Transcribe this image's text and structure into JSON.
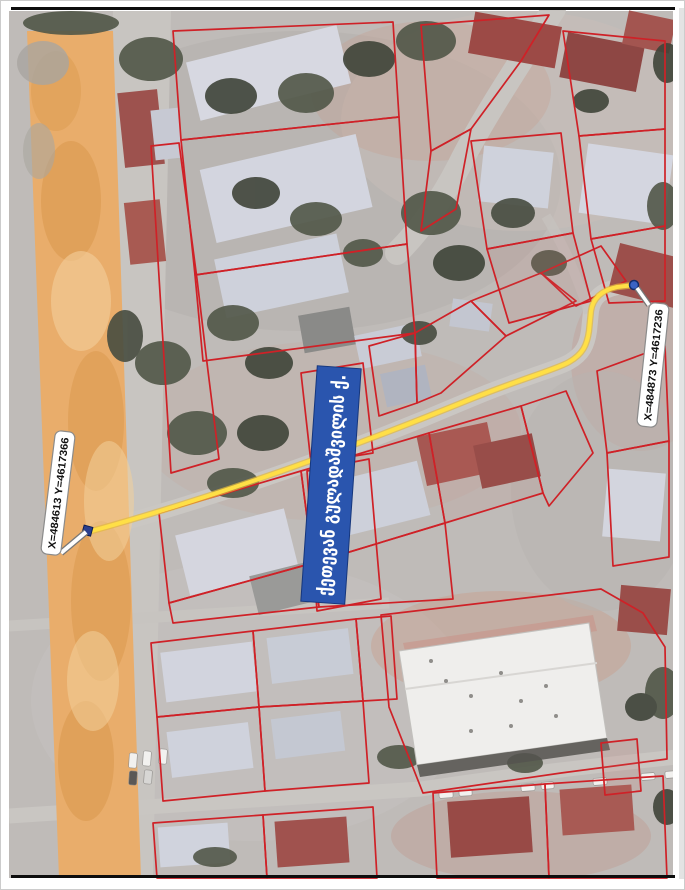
{
  "map": {
    "street_banner": {
      "label": "ქეთევან გულადაშვილის ქ."
    },
    "callout_start": {
      "label": "X=484613 Y=4617366"
    },
    "callout_end": {
      "label": "X=484873 Y=4617236"
    },
    "colors": {
      "parcel": "#cf2127",
      "route": "#ffdf46",
      "route_casing": "#e3b93f",
      "banner": "#2a55ae",
      "highlight_road": "#e9ad6b",
      "marker": "#2b3f8e",
      "end_marker": "#3a63c4"
    }
  }
}
